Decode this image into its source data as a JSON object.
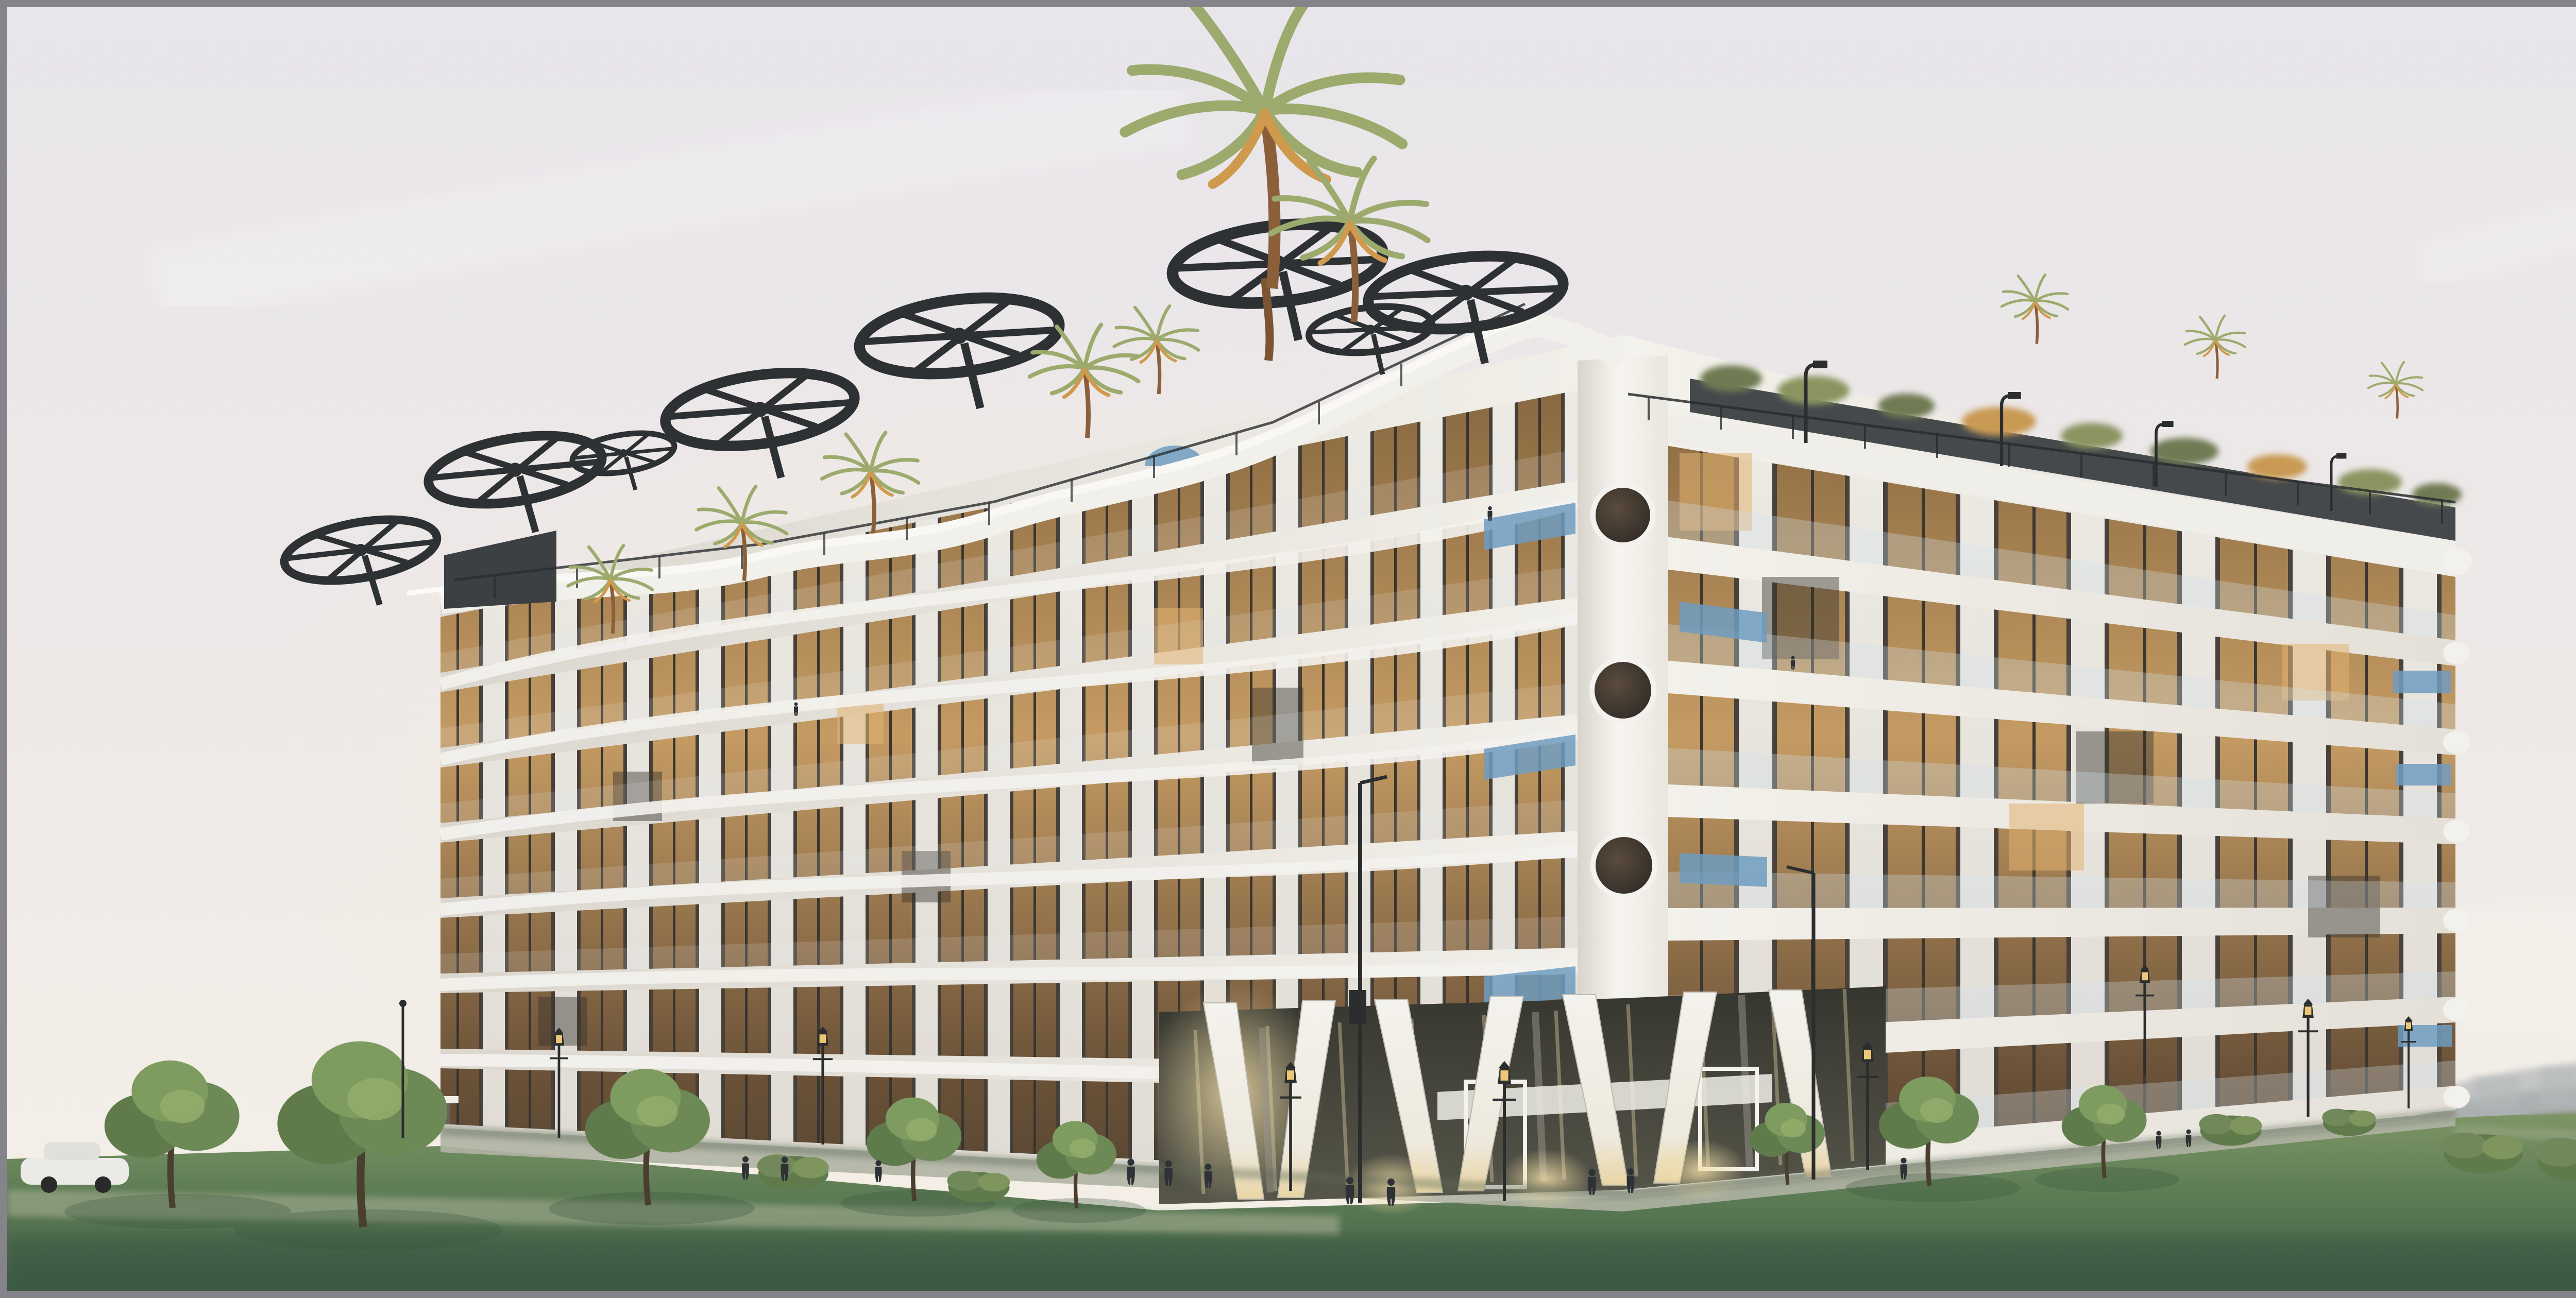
{
  "image": {
    "type": "architectural-rendering",
    "subject": "curved white residential building with rooftop palm garden at dusk",
    "setting": "park lawn with trees, street lamps, distant hazy hills"
  },
  "colors": {
    "frame": "#85848a",
    "sky_top": "#e8e5eb",
    "sky_mid": "#eee9e7",
    "sky_horizon": "#f5f0e7",
    "hill": "#a7acaf",
    "hill_near": "#949c9e",
    "treeline": "#6b8054",
    "conifer": "#3e5136",
    "grass_top": "#7d9566",
    "grass_bottom": "#3e5c45",
    "path": "#a4ae93",
    "plaza": "#b0b2a3",
    "wall_light": "#f2f0ea",
    "wall_shade": "#dbd7cf",
    "window_dark": "#433c33",
    "window_glow": "#c59b63",
    "balustrade_glass": "#cfe0ea",
    "accent_blue": "#6f9cc0",
    "roof_screen": "#45494c",
    "pergola": "#2d3134",
    "railing": "#2a2d2f",
    "palm_green": "#9cab6d",
    "palm_warm": "#d09a4e",
    "trunk": "#8a5f3a",
    "lamp": "#2b2d2e",
    "lamp_glow": "#ecc775",
    "people": "#2e3237",
    "tree_green": "#5f7b4c",
    "shadow": "#3c5540",
    "lobby_glass": "#35362f",
    "lobby_glow": "#f3dfa9"
  },
  "scene": {
    "building": {
      "floors_left_facade": 7,
      "floors_right_facade": 6,
      "porthole_windows": 4,
      "entrance_columns": 7
    },
    "rooftop": {
      "pergola_wheels": 8,
      "palm_trees": 10,
      "roof_lamps": 4
    },
    "grounds": {
      "street_lamps": 12,
      "foreground_trees": 8,
      "people": 16,
      "cars": 1
    }
  }
}
